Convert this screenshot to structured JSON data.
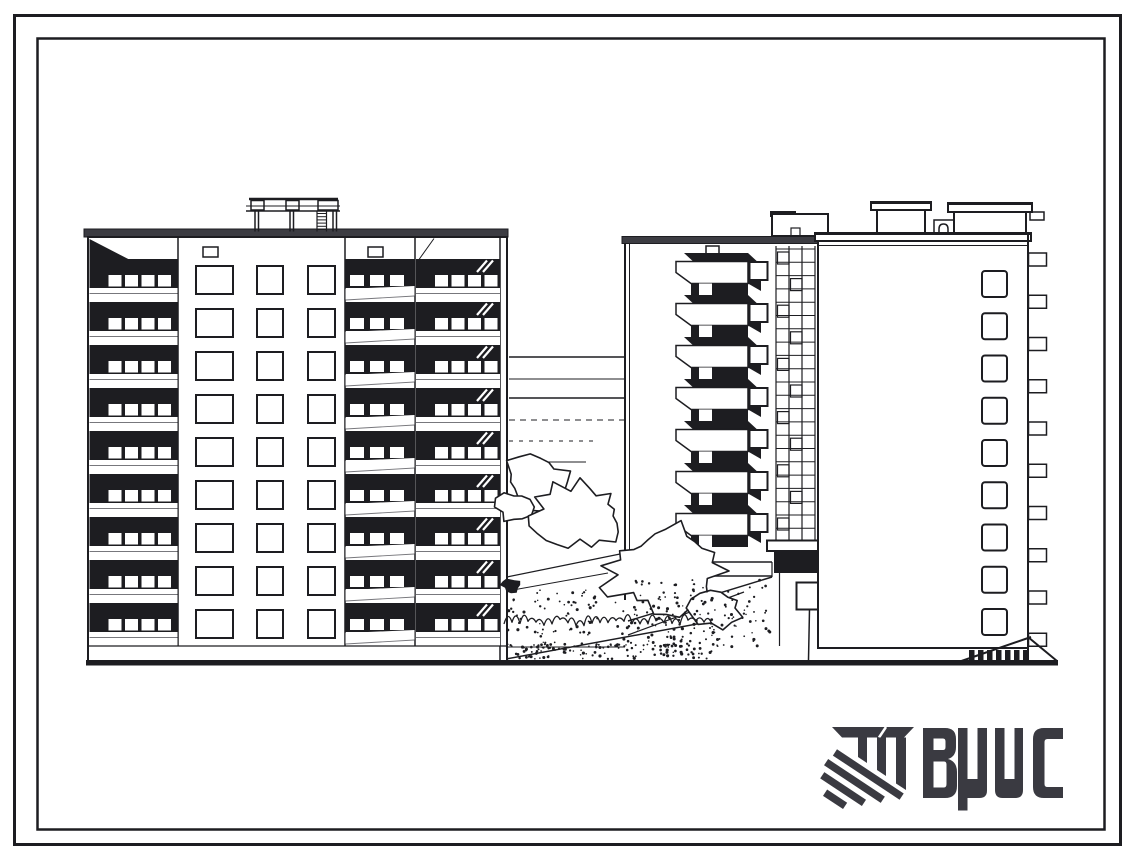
{
  "document": {
    "kind": "scanned architectural elevation drawing",
    "logo": {
      "text": "ВЦИС",
      "letters": [
        "В",
        "Ц",
        "И",
        "С"
      ],
      "mark": "hatched-construction-monogram"
    },
    "colors": {
      "paper": "#ffffff",
      "ink": "#1d1d21",
      "logo_ink": "#3a3a41",
      "cornice": "#3c3c42",
      "faint": "#77777c"
    },
    "drawing": {
      "left_building": {
        "floors": 9,
        "window_rows": 9,
        "window_columns": 3,
        "balcony_stacks": 3,
        "has_roof_pergola": true
      },
      "rear_building": {
        "balcony_floors": 7,
        "window_column_floors": 7,
        "has_stair_glazing": true,
        "has_entrance_canopy": true
      },
      "front_building": {
        "window_count": 9,
        "side_tab_count": 10,
        "penthouse_count": 2,
        "fence_post_count": 7
      },
      "site": {
        "perspective_line_count": 6,
        "bush_count": 5,
        "has_ground_line": true
      }
    }
  }
}
